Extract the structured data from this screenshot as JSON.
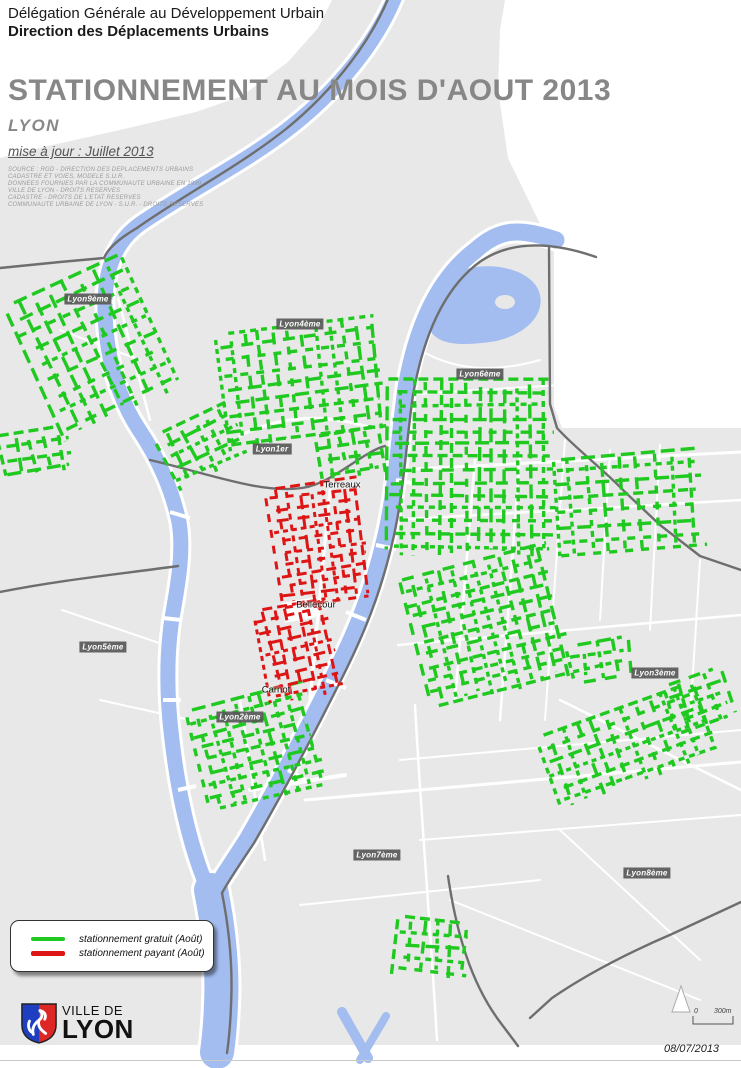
{
  "header": {
    "org_line1": "Délégation Générale au Développement Urbain",
    "org_line2": "Direction des Déplacements Urbains",
    "title": "STATIONNEMENT AU MOIS D'AOUT 2013",
    "subtitle": "LYON",
    "update_note": "mise à jour : Juillet 2013",
    "source_lines": [
      "SOURCE : RGD - DIRECTION DES DEPLACEMENTS URBAINS",
      "CADASTRE ET VOIES, MODELE S.U.R.",
      "DONNEES FOURNIES PAR LA COMMUNAUTE URBAINE EN 1999",
      "VILLE DE LYON - DROITS RESERVES",
      "CADASTRE - DROITS DE L'ETAT RESERVES",
      "COMMUNAUTE URBAINE DE LYON - S.U.R. - DROITS RESERVES"
    ]
  },
  "map": {
    "colors": {
      "gratuit": "#1fc91f",
      "payant": "#dd1515",
      "river": "#a3bdf0",
      "land": "#e8e8e8",
      "boundary": "#6e6e6e"
    },
    "district_labels": [
      {
        "label": "Lyon9ème",
        "x": 88,
        "y": 299
      },
      {
        "label": "Lyon4ème",
        "x": 300,
        "y": 324
      },
      {
        "label": "Lyon6ème",
        "x": 480,
        "y": 374
      },
      {
        "label": "Lyon1er",
        "x": 272,
        "y": 449
      },
      {
        "label": "Lyon5ème",
        "x": 103,
        "y": 647
      },
      {
        "label": "Lyon2ème",
        "x": 240,
        "y": 717
      },
      {
        "label": "Lyon3ème",
        "x": 655,
        "y": 673
      },
      {
        "label": "Lyon7ème",
        "x": 377,
        "y": 855
      },
      {
        "label": "Lyon8ème",
        "x": 647,
        "y": 873
      }
    ],
    "place_labels": [
      {
        "label": "Terreaux",
        "x": 342,
        "y": 485
      },
      {
        "label": "Bellecour",
        "x": 316,
        "y": 605
      },
      {
        "label": "Carnot",
        "x": 276,
        "y": 690
      }
    ],
    "parking_zones": [
      {
        "type": "gratuit",
        "cx": 95,
        "cy": 348,
        "w": 130,
        "h": 150,
        "rot": -25,
        "sx": 16,
        "sy": 17
      },
      {
        "type": "gratuit",
        "cx": 38,
        "cy": 452,
        "w": 72,
        "h": 46,
        "rot": -10,
        "sx": 15,
        "sy": 14
      },
      {
        "type": "gratuit",
        "cx": 303,
        "cy": 383,
        "w": 160,
        "h": 118,
        "rot": -7,
        "sx": 14,
        "sy": 14
      },
      {
        "type": "gratuit",
        "cx": 204,
        "cy": 446,
        "w": 82,
        "h": 62,
        "rot": -25,
        "sx": 14,
        "sy": 13
      },
      {
        "type": "gratuit",
        "cx": 350,
        "cy": 455,
        "w": 66,
        "h": 48,
        "rot": -10,
        "sx": 13,
        "sy": 13
      },
      {
        "type": "gratuit",
        "cx": 472,
        "cy": 468,
        "w": 168,
        "h": 178,
        "rot": 0,
        "sx": 13,
        "sy": 13
      },
      {
        "type": "gratuit",
        "cx": 630,
        "cy": 506,
        "w": 150,
        "h": 106,
        "rot": -4,
        "sx": 17,
        "sy": 14
      },
      {
        "type": "gratuit",
        "cx": 489,
        "cy": 628,
        "w": 152,
        "h": 136,
        "rot": -14,
        "sx": 13,
        "sy": 13
      },
      {
        "type": "gratuit",
        "cx": 258,
        "cy": 748,
        "w": 126,
        "h": 106,
        "rot": -14,
        "sx": 13,
        "sy": 13
      },
      {
        "type": "gratuit",
        "cx": 600,
        "cy": 660,
        "w": 60,
        "h": 40,
        "rot": -10,
        "sx": 15,
        "sy": 13
      },
      {
        "type": "gratuit",
        "cx": 628,
        "cy": 747,
        "w": 170,
        "h": 82,
        "rot": -20,
        "sx": 15,
        "sy": 14
      },
      {
        "type": "gratuit",
        "cx": 432,
        "cy": 950,
        "w": 76,
        "h": 60,
        "rot": 4,
        "sx": 14,
        "sy": 13
      },
      {
        "type": "gratuit",
        "cx": 700,
        "cy": 700,
        "w": 62,
        "h": 52,
        "rot": -20,
        "sx": 15,
        "sy": 13
      },
      {
        "type": "payant",
        "cx": 320,
        "cy": 545,
        "w": 92,
        "h": 126,
        "rot": -8,
        "sx": 11,
        "sy": 11
      },
      {
        "type": "payant",
        "cx": 300,
        "cy": 652,
        "w": 76,
        "h": 96,
        "rot": -12,
        "sx": 11,
        "sy": 11
      }
    ]
  },
  "legend": {
    "items": [
      {
        "swatch": "gratuit",
        "label": "stationnement gratuit (Août)"
      },
      {
        "swatch": "payant",
        "label": "stationnement payant (Août)"
      }
    ]
  },
  "footer": {
    "logo_text_top": "VILLE DE",
    "logo_text_bottom": "LYON",
    "scale_zero": "0",
    "scale_label": "300m",
    "date": "08/07/2013"
  }
}
